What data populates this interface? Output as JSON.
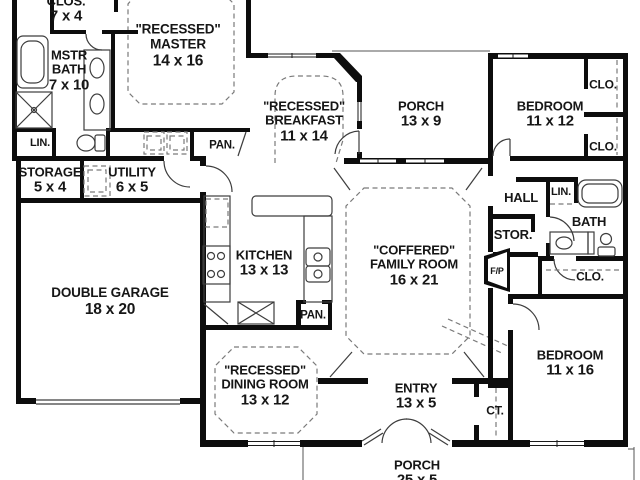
{
  "document_type": "single-story house floor plan",
  "colors": {
    "wall": "#0d0d0d",
    "background": "#ffffff",
    "thin_line": "#3d3d3d",
    "dashed_line": "#7a7a7a",
    "text": "#161616"
  },
  "rooms": [
    {
      "id": "closet-master",
      "x": 66,
      "y": 10,
      "fs": 13,
      "lines": [
        "CLOS.",
        "7 x 4"
      ]
    },
    {
      "id": "master-bedroom",
      "x": 178,
      "y": 46,
      "fs": 13.5,
      "lines": [
        "\"RECESSED\"",
        "MASTER",
        "14 x 16"
      ]
    },
    {
      "id": "master-bath",
      "x": 69,
      "y": 71,
      "fs": 13,
      "lines": [
        "MSTR",
        "BATH",
        "7 x 10"
      ]
    },
    {
      "id": "linen-left",
      "x": 40,
      "y": 143,
      "fs": 11,
      "lines": [
        "LIN."
      ]
    },
    {
      "id": "pantry-top",
      "x": 222,
      "y": 146,
      "fs": 11.5,
      "lines": [
        "PAN."
      ]
    },
    {
      "id": "storage",
      "x": 50,
      "y": 181,
      "fs": 13,
      "lines": [
        "STORAGE",
        "5 x 4"
      ]
    },
    {
      "id": "utility",
      "x": 132,
      "y": 181,
      "fs": 13,
      "lines": [
        "UTILITY",
        "6 x 5"
      ]
    },
    {
      "id": "double-garage",
      "x": 110,
      "y": 302,
      "fs": 13.5,
      "lines": [
        "DOUBLE GARAGE",
        "18 x 20"
      ]
    },
    {
      "id": "kitchen",
      "x": 264,
      "y": 264,
      "fs": 13,
      "lines": [
        "KITCHEN",
        "13 x 13"
      ]
    },
    {
      "id": "pantry-kitchen",
      "x": 313,
      "y": 316,
      "fs": 11.5,
      "lines": [
        "PAN."
      ]
    },
    {
      "id": "breakfast",
      "x": 304,
      "y": 122,
      "fs": 13,
      "lines": [
        "\"RECESSED\"",
        "BREAKFAST",
        "11 x 14"
      ]
    },
    {
      "id": "porch-rear",
      "x": 421,
      "y": 115,
      "fs": 13,
      "lines": [
        "PORCH",
        "13 x 9"
      ]
    },
    {
      "id": "family-room",
      "x": 414,
      "y": 266,
      "fs": 13,
      "lines": [
        "\"COFFERED\"",
        "FAMILY ROOM",
        "16 x 21"
      ]
    },
    {
      "id": "hall",
      "x": 521,
      "y": 198,
      "fs": 13,
      "lines": [
        "HALL"
      ]
    },
    {
      "id": "linen-right",
      "x": 561,
      "y": 192,
      "fs": 11,
      "lines": [
        "LIN."
      ]
    },
    {
      "id": "bath",
      "x": 589,
      "y": 222,
      "fs": 13,
      "lines": [
        "BATH"
      ]
    },
    {
      "id": "storage-hall",
      "x": 513,
      "y": 235,
      "fs": 13,
      "lines": [
        "STOR."
      ]
    },
    {
      "id": "fireplace",
      "x": 497,
      "y": 272,
      "fs": 9,
      "lines": [
        "F/P"
      ]
    },
    {
      "id": "closet-bath",
      "x": 590,
      "y": 277,
      "fs": 12,
      "lines": [
        "CLO."
      ]
    },
    {
      "id": "bedroom-2",
      "x": 550,
      "y": 115,
      "fs": 13,
      "lines": [
        "BEDROOM",
        "11 x 12"
      ]
    },
    {
      "id": "closet-2-top",
      "x": 603,
      "y": 85,
      "fs": 12,
      "lines": [
        "CLO."
      ]
    },
    {
      "id": "closet-2-bottom",
      "x": 603,
      "y": 147,
      "fs": 12,
      "lines": [
        "CLO."
      ]
    },
    {
      "id": "bedroom-3",
      "x": 570,
      "y": 364,
      "fs": 13,
      "lines": [
        "BEDROOM",
        "11 x 16"
      ]
    },
    {
      "id": "coat-closet",
      "x": 495,
      "y": 411,
      "fs": 12,
      "lines": [
        "CT."
      ]
    },
    {
      "id": "entry",
      "x": 416,
      "y": 397,
      "fs": 13,
      "lines": [
        "ENTRY",
        "13 x 5"
      ]
    },
    {
      "id": "dining-room",
      "x": 265,
      "y": 386,
      "fs": 13,
      "lines": [
        "\"RECESSED\"",
        "DINING ROOM",
        "13 x 12"
      ]
    },
    {
      "id": "porch-front",
      "x": 417,
      "y": 474,
      "fs": 13,
      "lines": [
        "PORCH",
        "25 x 5"
      ]
    }
  ]
}
